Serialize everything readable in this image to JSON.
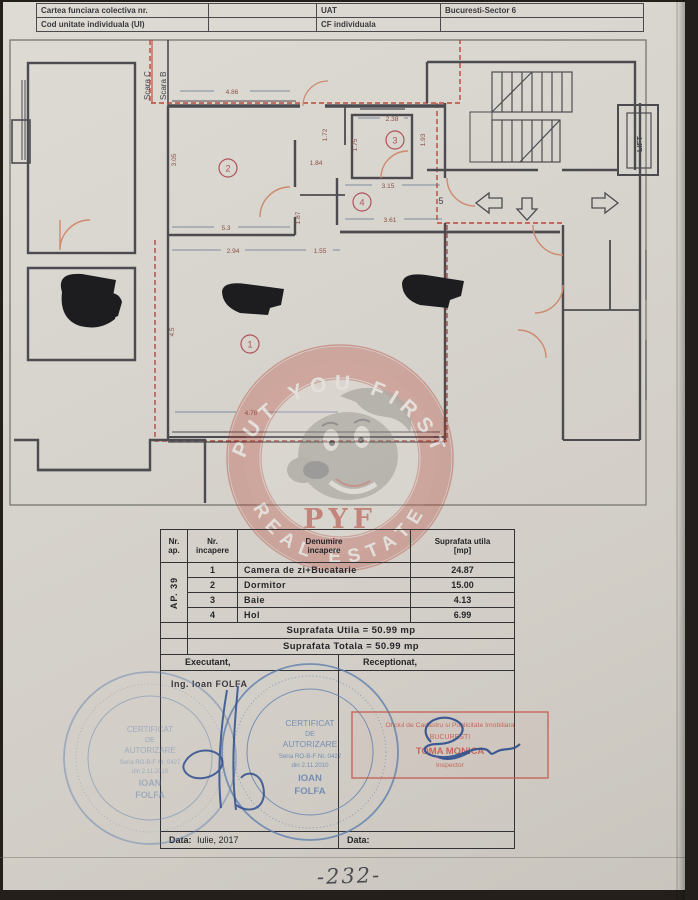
{
  "header": {
    "r1c1": "Cartea funciara colectiva nr.",
    "r1c2": "",
    "r1c3": "UAT",
    "r1c4": "Bucuresti-Sector 6",
    "r2c1": "Cod unitate individuala (UI)",
    "r2c2": "",
    "r2c3": "CF individuala",
    "r2c4": ""
  },
  "plan": {
    "scara": [
      "Scara C",
      "Scara B"
    ],
    "lift": "LIFT",
    "rooms": [
      "1",
      "2",
      "3",
      "4"
    ],
    "door_number": "5",
    "dims": [
      "4.86",
      "3.05",
      "1.72",
      "1.75",
      "1.84",
      "1.93",
      "2.38",
      "3.15",
      "3.61",
      "5.3",
      "2.94",
      "1.55",
      "1.87",
      "4.5",
      "4.78"
    ],
    "colors": {
      "wall": "#4c4c50",
      "boundary_red": "#b8493a",
      "door_arc": "#cd8a6e",
      "dim_line": "#5f7690",
      "dim_text": "#8a5048"
    }
  },
  "watermark": {
    "top": "PUT YOU FIRST",
    "bottom": "REAL ESTATE",
    "initials": "PYF",
    "ring_color": "#b53c30"
  },
  "table": {
    "headers": {
      "col1": "Nr.\nap.",
      "col2": "Nr.\nincapere",
      "col3": "Denumire\nincapere",
      "col4": "Suprafata utila\n[mp]"
    },
    "apartment_label": "AP. 39",
    "rows": [
      {
        "nr": "1",
        "name": "Camera de zi+Bucatarie",
        "area": "24.87"
      },
      {
        "nr": "2",
        "name": "Dormitor",
        "area": "15.00"
      },
      {
        "nr": "3",
        "name": "Baie",
        "area": "4.13"
      },
      {
        "nr": "4",
        "name": "Hol",
        "area": "6.99"
      }
    ],
    "total_utila": "Suprafata Utila = 50.99 mp",
    "total_totala": "Suprafata Totala = 50.99 mp",
    "executant_label": "Executant,",
    "receptionat_label": "Receptionat,",
    "executant_name": "Ing. Ioan FOLFA",
    "data_left_label": "Data:",
    "data_left_value": "Iulie, 2017",
    "data_right_label": "Data:"
  },
  "stamps": {
    "blue_round": {
      "lines": [
        "CERTIFICAT",
        "DE",
        "AUTORIZARE",
        "Seria RO-B-F Nr. 0427",
        "din 2.11.2010",
        "IOAN",
        "FOLFA"
      ],
      "color": "#5f7fae"
    },
    "red_box": {
      "lines": [
        "Oficiul de Cadastru si Publicitate Imobiliara",
        "BUCURESTI",
        "TOMA MONICA",
        "Inspector"
      ],
      "color": "#c4564a"
    }
  },
  "page_number": "-232-"
}
